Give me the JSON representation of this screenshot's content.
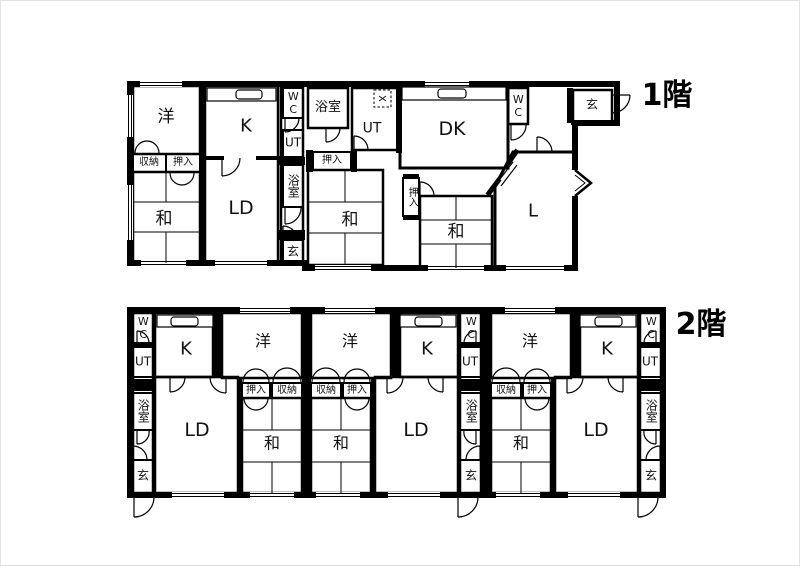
{
  "figure": {
    "type": "floor-plan",
    "background": "#ffffff",
    "wall_color": "#000000"
  },
  "floors": [
    {
      "id": "1f",
      "label": "1階",
      "rooms": {
        "yo": {
          "label": "洋"
        },
        "k": {
          "label": "K"
        },
        "wc_left": {
          "label": "WC"
        },
        "ut_left": {
          "label": "UT"
        },
        "bath_left": {
          "label": "浴室"
        },
        "genkan_left": {
          "label": "玄"
        },
        "shuno": {
          "label": "収納"
        },
        "oshiire_a": {
          "label": "押入"
        },
        "wa_a": {
          "label": "和"
        },
        "ld": {
          "label": "LD"
        },
        "bath_mid": {
          "label": "浴室"
        },
        "ut_mid": {
          "label": "UT"
        },
        "oshiire_b": {
          "label": "押入"
        },
        "wa_b": {
          "label": "和"
        },
        "dk": {
          "label": "DK"
        },
        "wc_right": {
          "label": "WC"
        },
        "genkan_right": {
          "label": "玄"
        },
        "oshiire_c": {
          "label": "押入"
        },
        "wa_c": {
          "label": "和"
        },
        "living": {
          "label": "L"
        }
      }
    },
    {
      "id": "2f",
      "label": "2階",
      "units": [
        {
          "rooms": {
            "wc": {
              "label": "WC"
            },
            "k": {
              "label": "K"
            },
            "yo": {
              "label": "洋"
            },
            "ut": {
              "label": "UT"
            },
            "bath": {
              "label": "浴室"
            },
            "genkan": {
              "label": "玄"
            },
            "ld": {
              "label": "LD"
            },
            "oshiire": {
              "label": "押入"
            },
            "shuno": {
              "label": "収納"
            },
            "wa": {
              "label": "和"
            }
          }
        },
        {
          "rooms": {
            "wc": {
              "label": "WC"
            },
            "k": {
              "label": "K"
            },
            "yo": {
              "label": "洋"
            },
            "ut": {
              "label": "UT"
            },
            "bath": {
              "label": "浴室"
            },
            "genkan": {
              "label": "玄"
            },
            "ld": {
              "label": "LD"
            },
            "oshiire": {
              "label": "押入"
            },
            "shuno": {
              "label": "収納"
            },
            "wa": {
              "label": "和"
            }
          }
        },
        {
          "rooms": {
            "wc": {
              "label": "WC"
            },
            "k": {
              "label": "K"
            },
            "yo": {
              "label": "洋"
            },
            "ut": {
              "label": "UT"
            },
            "bath": {
              "label": "浴室"
            },
            "genkan": {
              "label": "玄"
            },
            "ld": {
              "label": "LD"
            },
            "oshiire": {
              "label": "押入"
            },
            "shuno": {
              "label": "収納"
            },
            "wa": {
              "label": "和"
            }
          }
        }
      ]
    }
  ]
}
